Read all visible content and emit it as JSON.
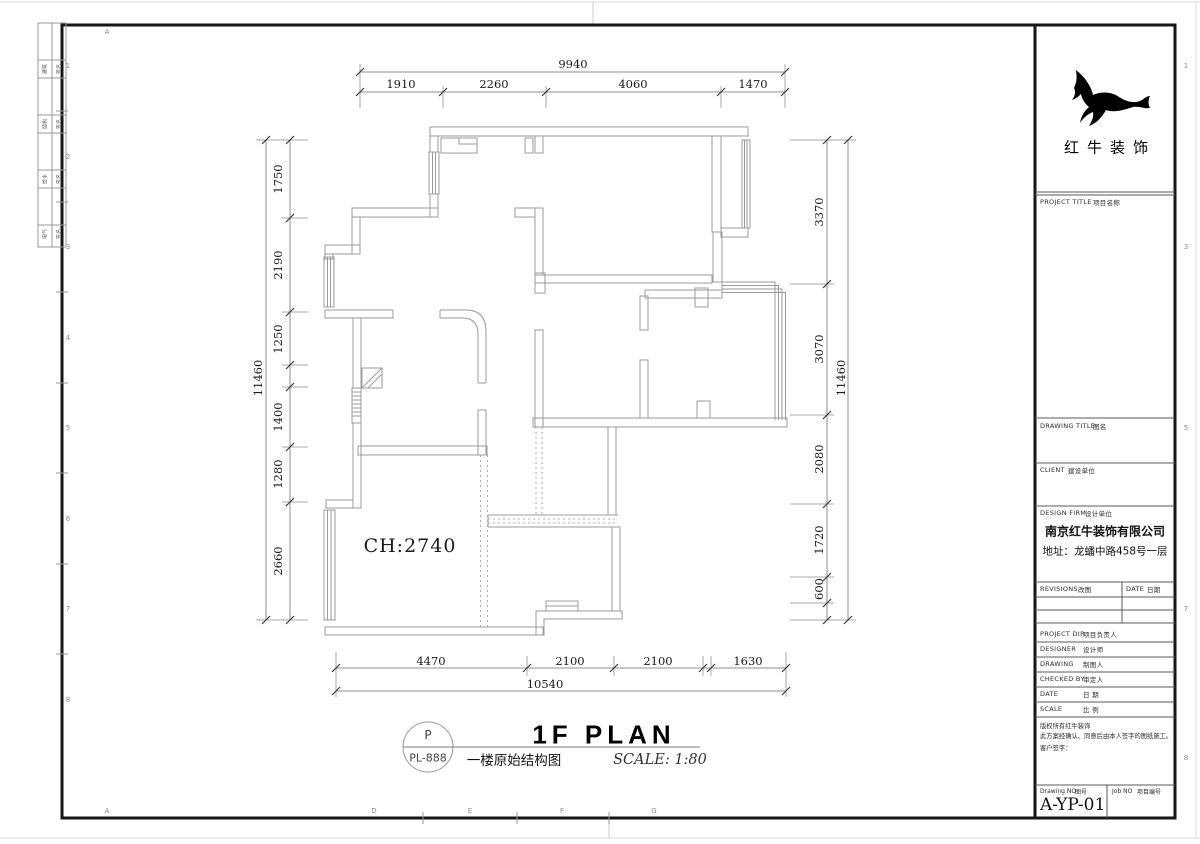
{
  "sheet": {
    "top_letter": "A",
    "bottom_letters": [
      "A",
      "D",
      "E",
      "F",
      "G"
    ],
    "left_numbers": [
      "1",
      "2",
      "3",
      "4",
      "5",
      "6",
      "7",
      "8"
    ],
    "right_numbers": [
      "1",
      "2",
      "3",
      "4",
      "5",
      "6",
      "7",
      "8"
    ],
    "signoff_rows": [
      [
        "建筑",
        "签名"
      ],
      [
        "结构",
        "签名"
      ],
      [
        "给水",
        "签名"
      ],
      [
        "电气",
        "签名"
      ]
    ]
  },
  "plan": {
    "ceiling_label": "CH:2740",
    "dims": {
      "top_total": "9940",
      "top_segments": [
        "1910",
        "2260",
        "4060",
        "1470"
      ],
      "bottom_segments": [
        "4470",
        "2100",
        "2100",
        "1630"
      ],
      "bottom_total": "10540",
      "left_total": "11460",
      "left_segments": [
        "1750",
        "2190",
        "1250",
        "1400",
        "1280",
        "2660"
      ],
      "right_segments": [
        "3370",
        "3070",
        "2080",
        "1720",
        "600"
      ],
      "right_total": "11460"
    }
  },
  "title_area": {
    "bubble_top": "P",
    "bubble_bottom": "PL-888",
    "title_en": "1F PLAN",
    "title_cn": "一楼原始结构图",
    "scale": "SCALE: 1:80"
  },
  "title_block": {
    "logo_text": "红牛装饰",
    "project_title_en": "PROJECT TITLE",
    "project_title_cn": "项目名称",
    "drawing_title_en": "DRAWING TITLE",
    "drawing_title_cn": "图名",
    "client_en": "CLIENT",
    "client_cn": "建设单位",
    "design_firm_en": "DESIGN FIRM",
    "design_firm_cn": "设计单位",
    "company": "南京红牛装饰有限公司",
    "address": "地址：龙蟠中路458号一层",
    "revisions_en": "REVISIONS",
    "revisions_cn": "改图",
    "date_en": "DATE",
    "date_cn": "日期",
    "rows": [
      {
        "en": "PROJECT DIR",
        "cn": "项目负责人"
      },
      {
        "en": "DESIGNER",
        "cn": "设计师"
      },
      {
        "en": "DRAWING",
        "cn": "制图人"
      },
      {
        "en": "CHECKED BY",
        "cn": "审定人"
      },
      {
        "en": "DATE",
        "cn": "日  期"
      },
      {
        "en": "SCALE",
        "cn": "比  例"
      }
    ],
    "copyright_line1": "版权所有红牛装饰",
    "copyright_line2": "此方案经确认、同意后由本人签字的图纸施工。",
    "signature_label": "客户签字：",
    "drawing_no_en": "Drawing NO",
    "drawing_no_cn": "图号",
    "job_no_en": "Job NO",
    "job_no_cn": "项目编号",
    "drawing_no": "A-YP-01"
  }
}
